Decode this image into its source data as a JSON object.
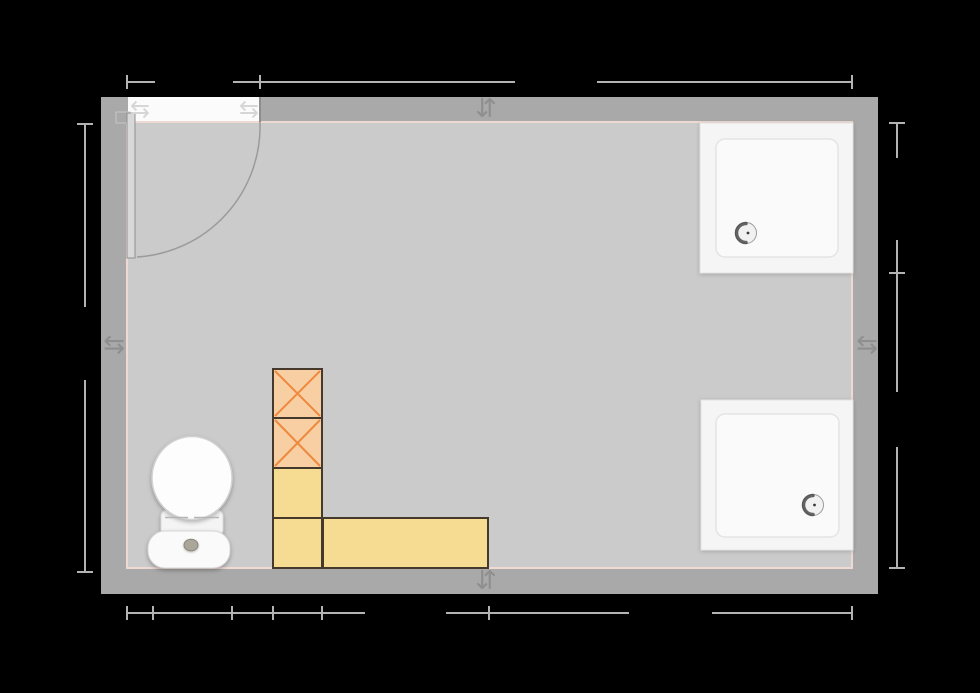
{
  "canvas": {
    "width": 980,
    "height": 693,
    "viewBox": "0 0 980 693",
    "background": "#000000"
  },
  "palette": {
    "wall": "#a9a9a9",
    "floor": "#cbcbcb",
    "inner_wall_trim": "#eed9d3",
    "dimension_line": "#b3b3b3",
    "door_opening": "#fbfbfb",
    "indicator_arrow": "#8f8f8f",
    "box_orange_fill": "#f8cfa3",
    "box_orange_cross": "#ee8a3f",
    "box_yellow_fill": "#f5dc92",
    "box_border": "#45392c",
    "fixture_white": "#f5f5f5"
  },
  "icons": [
    "door-swap-arrows-left-icon",
    "door-swap-arrows-right-icon",
    "wall-direction-indicator-top-icon",
    "wall-direction-indicator-bottom-icon",
    "wall-direction-indicator-left-icon",
    "wall-direction-indicator-right-icon"
  ],
  "scene": [
    {
      "t": "rect",
      "name": "wall-outer",
      "i": true,
      "x": 101,
      "y": 97,
      "w": 777,
      "h": 497,
      "f": "#a9a9a9"
    },
    {
      "t": "rect",
      "name": "room-floor",
      "i": true,
      "x": 127,
      "y": 122,
      "w": 725,
      "h": 446,
      "f": "#cbcbcb",
      "s": "#eed9d3",
      "sw": 2
    },
    {
      "t": "rect",
      "name": "door-opening",
      "i": true,
      "x": 128,
      "y": 97,
      "w": 132,
      "h": 24,
      "f": "#fbfbfb"
    },
    {
      "t": "line",
      "name": "door-jamb-line",
      "i": false,
      "x1": 260,
      "y1": 97,
      "x2": 260,
      "y2": 122,
      "s": "#8d8d8d",
      "sw": 2
    },
    {
      "t": "rect",
      "name": "door-hinge-block",
      "i": false,
      "x": 116,
      "y": 112,
      "w": 14,
      "h": 11,
      "f": "#a9a9a9",
      "s": "#c8c8c8",
      "sw": 1
    },
    {
      "t": "path",
      "name": "door-swing-arc",
      "i": false,
      "d": "M 260 122 A 131 131 0 0 1 137 257",
      "s": "#9b9b9b",
      "sw": 1.5
    },
    {
      "t": "rect",
      "name": "door-panel",
      "i": true,
      "x": 127,
      "y": 113,
      "w": 8,
      "h": 145,
      "f": "#d8d8d8",
      "s": "#8f8f8f",
      "sw": 1
    },
    {
      "t": "text",
      "name": "door-swap-arrows-left-icon",
      "i": false,
      "x": 140,
      "y": 109,
      "str": "⇆",
      "fs": 24,
      "f": "#d6d6d6"
    },
    {
      "t": "text",
      "name": "door-swap-arrows-right-icon",
      "i": false,
      "x": 249,
      "y": 109,
      "str": "⇆",
      "fs": 24,
      "f": "#d6d6d6"
    },
    {
      "t": "text",
      "name": "wall-direction-indicator-top-icon",
      "i": false,
      "x": 486,
      "y": 109,
      "str": "⇵",
      "fs": 26,
      "f": "#8f8f8f"
    },
    {
      "t": "text",
      "name": "wall-direction-indicator-bottom-icon",
      "i": false,
      "x": 486,
      "y": 581,
      "str": "⇵",
      "fs": 26,
      "f": "#8f8f8f"
    },
    {
      "t": "text",
      "name": "wall-direction-indicator-left-icon",
      "i": false,
      "x": 114,
      "y": 345,
      "str": "⇆",
      "fs": 26,
      "f": "#8f8f8f"
    },
    {
      "t": "text",
      "name": "wall-direction-indicator-right-icon",
      "i": false,
      "x": 867,
      "y": 345,
      "str": "⇆",
      "fs": 26,
      "f": "#8f8f8f"
    },
    {
      "t": "rect",
      "name": "shower-tray-outer",
      "i": true,
      "x": 700,
      "y": 123,
      "w": 153,
      "h": 150,
      "f": "#f5f5f5",
      "s": "#e2e2e2",
      "sw": 1
    },
    {
      "t": "rect",
      "name": "shower-tray-basin",
      "i": false,
      "x": 716,
      "y": 139,
      "w": 122,
      "h": 118,
      "rx": 9,
      "f": "#fafafa",
      "s": "#e4e4e4",
      "sw": 1.5
    },
    {
      "t": "circle",
      "name": "shower-drain",
      "i": false,
      "cx": 746,
      "cy": 233,
      "r": 10.5,
      "f": "#f1f1f1",
      "s": "#9c9c9c",
      "sw": 1
    },
    {
      "t": "path",
      "name": "shower-drain-shadow",
      "i": false,
      "d": "M 746 223.5 A 9.5 9.5 0 0 0 746 242.5",
      "s": "#4a4a4a",
      "sw": 3.5,
      "lc": "round",
      "o": 0.85
    },
    {
      "t": "circle",
      "name": "shower-drain-dot",
      "i": false,
      "cx": 748,
      "cy": 233,
      "r": 1.4,
      "f": "#3a3a3a"
    },
    {
      "t": "rect",
      "name": "shower-tray-outer",
      "i": true,
      "x": 701,
      "y": 400,
      "w": 152,
      "h": 150,
      "f": "#f5f5f5",
      "s": "#e2e2e2",
      "sw": 1
    },
    {
      "t": "rect",
      "name": "shower-tray-basin",
      "i": false,
      "x": 716,
      "y": 414,
      "w": 123,
      "h": 123,
      "rx": 9,
      "f": "#fafafa",
      "s": "#e4e4e4",
      "sw": 1.5
    },
    {
      "t": "circle",
      "name": "shower-drain",
      "i": false,
      "cx": 813,
      "cy": 505,
      "r": 10.5,
      "f": "#f1f1f1",
      "s": "#9c9c9c",
      "sw": 1
    },
    {
      "t": "path",
      "name": "shower-drain-shadow",
      "i": false,
      "d": "M 813 495.5 A 9.5 9.5 0 0 0 813 514.5",
      "s": "#4a4a4a",
      "sw": 3.5,
      "lc": "round",
      "o": 0.85
    },
    {
      "t": "circle",
      "name": "shower-drain-dot",
      "i": false,
      "cx": 814.5,
      "cy": 505,
      "r": 1.4,
      "f": "#3a3a3a"
    },
    {
      "t": "rect",
      "name": "storage-box-crossed-1",
      "i": true,
      "x": 273,
      "y": 369,
      "w": 49,
      "h": 49,
      "f": "#f8cfa3",
      "s": "#45392c",
      "sw": 2
    },
    {
      "t": "line",
      "name": "box-cross-line",
      "i": false,
      "x1": 275,
      "y1": 371,
      "x2": 320,
      "y2": 416,
      "s": "#ee8a3f",
      "sw": 2
    },
    {
      "t": "line",
      "name": "box-cross-line",
      "i": false,
      "x1": 320,
      "y1": 371,
      "x2": 275,
      "y2": 416,
      "s": "#ee8a3f",
      "sw": 2
    },
    {
      "t": "rect",
      "name": "storage-box-crossed-2",
      "i": true,
      "x": 273,
      "y": 418,
      "w": 49,
      "h": 50,
      "f": "#f8cfa3",
      "s": "#45392c",
      "sw": 2
    },
    {
      "t": "line",
      "name": "box-cross-line",
      "i": false,
      "x1": 275,
      "y1": 420,
      "x2": 320,
      "y2": 466,
      "s": "#ee8a3f",
      "sw": 2
    },
    {
      "t": "line",
      "name": "box-cross-line",
      "i": false,
      "x1": 320,
      "y1": 420,
      "x2": 275,
      "y2": 466,
      "s": "#ee8a3f",
      "sw": 2
    },
    {
      "t": "rect",
      "name": "storage-box-yellow-1",
      "i": true,
      "x": 273,
      "y": 468,
      "w": 49,
      "h": 50,
      "f": "#f5dc92",
      "s": "#45392c",
      "sw": 2
    },
    {
      "t": "rect",
      "name": "storage-box-yellow-2",
      "i": true,
      "x": 273,
      "y": 518,
      "w": 49,
      "h": 50,
      "f": "#f5dc92",
      "s": "#45392c",
      "sw": 2
    },
    {
      "t": "rect",
      "name": "storage-box-yellow-long",
      "i": true,
      "x": 323,
      "y": 518,
      "w": 165,
      "h": 50,
      "f": "#f5dc92",
      "s": "#45392c",
      "sw": 2
    },
    {
      "t": "rect",
      "name": "toilet-seat",
      "i": true,
      "x": 161,
      "y": 510,
      "w": 62,
      "h": 26,
      "rx": 6,
      "f": "#f4f4f4",
      "s": "#dadada",
      "sw": 1
    },
    {
      "t": "rect",
      "name": "toilet-tank",
      "i": true,
      "x": 148,
      "y": 531,
      "w": 82,
      "h": 37,
      "rx": 17,
      "f": "#fafafa",
      "s": "#d6d6d6",
      "sw": 1
    },
    {
      "t": "ellipse",
      "name": "toilet-lid",
      "i": true,
      "cx": 192,
      "cy": 478,
      "rx": 40,
      "ry": 41.5,
      "f": "#fdfdfd",
      "s": "#d2d2d2",
      "sw": 1.5
    },
    {
      "t": "line",
      "name": "toilet-lid-seam",
      "i": false,
      "x1": 165,
      "y1": 517.5,
      "x2": 188,
      "y2": 517.5,
      "s": "#b5b5b5",
      "sw": 1.5
    },
    {
      "t": "line",
      "name": "toilet-lid-seam",
      "i": false,
      "x1": 194,
      "y1": 517.5,
      "x2": 219,
      "y2": 517.5,
      "s": "#b5b5b5",
      "sw": 1.5
    },
    {
      "t": "ellipse",
      "name": "flush-button",
      "i": false,
      "cx": 191,
      "cy": 545,
      "rx": 7,
      "ry": 5.8,
      "f": "#aaa699",
      "s": "#8a867a",
      "sw": 1
    },
    {
      "t": "line",
      "name": "dimension-top-segment",
      "i": true,
      "x1": 127,
      "y1": 82,
      "x2": 155,
      "y2": 82,
      "s": "#b3b3b3",
      "sw": 2
    },
    {
      "t": "line",
      "name": "dimension-top-segment",
      "i": true,
      "x1": 233,
      "y1": 82,
      "x2": 515,
      "y2": 82,
      "s": "#b3b3b3",
      "sw": 2
    },
    {
      "t": "line",
      "name": "dimension-top-segment",
      "i": true,
      "x1": 597,
      "y1": 82,
      "x2": 852,
      "y2": 82,
      "s": "#b3b3b3",
      "sw": 2
    },
    {
      "t": "line",
      "name": "dimension-top-tick",
      "i": false,
      "x1": 127,
      "y1": 75,
      "x2": 127,
      "y2": 89,
      "s": "#b3b3b3",
      "sw": 2
    },
    {
      "t": "line",
      "name": "dimension-top-tick",
      "i": false,
      "x1": 260,
      "y1": 75,
      "x2": 260,
      "y2": 89,
      "s": "#b3b3b3",
      "sw": 2
    },
    {
      "t": "line",
      "name": "dimension-top-tick",
      "i": false,
      "x1": 852,
      "y1": 75,
      "x2": 852,
      "y2": 89,
      "s": "#b3b3b3",
      "sw": 2
    },
    {
      "t": "line",
      "name": "dimension-bottom-segment",
      "i": true,
      "x1": 127,
      "y1": 613,
      "x2": 365,
      "y2": 613,
      "s": "#b3b3b3",
      "sw": 2
    },
    {
      "t": "line",
      "name": "dimension-bottom-segment",
      "i": true,
      "x1": 446,
      "y1": 613,
      "x2": 629,
      "y2": 613,
      "s": "#b3b3b3",
      "sw": 2
    },
    {
      "t": "line",
      "name": "dimension-bottom-segment",
      "i": true,
      "x1": 712,
      "y1": 613,
      "x2": 852,
      "y2": 613,
      "s": "#b3b3b3",
      "sw": 2
    },
    {
      "t": "line",
      "name": "dimension-bottom-tick",
      "i": false,
      "x1": 127,
      "y1": 606,
      "x2": 127,
      "y2": 620,
      "s": "#b3b3b3",
      "sw": 2
    },
    {
      "t": "line",
      "name": "dimension-bottom-tick",
      "i": false,
      "x1": 153,
      "y1": 606,
      "x2": 153,
      "y2": 620,
      "s": "#b3b3b3",
      "sw": 2
    },
    {
      "t": "line",
      "name": "dimension-bottom-tick",
      "i": false,
      "x1": 232,
      "y1": 606,
      "x2": 232,
      "y2": 620,
      "s": "#b3b3b3",
      "sw": 2
    },
    {
      "t": "line",
      "name": "dimension-bottom-tick",
      "i": false,
      "x1": 273,
      "y1": 606,
      "x2": 273,
      "y2": 620,
      "s": "#b3b3b3",
      "sw": 2
    },
    {
      "t": "line",
      "name": "dimension-bottom-tick",
      "i": false,
      "x1": 322,
      "y1": 606,
      "x2": 322,
      "y2": 620,
      "s": "#b3b3b3",
      "sw": 2
    },
    {
      "t": "line",
      "name": "dimension-bottom-tick",
      "i": false,
      "x1": 489,
      "y1": 606,
      "x2": 489,
      "y2": 620,
      "s": "#b3b3b3",
      "sw": 2
    },
    {
      "t": "line",
      "name": "dimension-bottom-tick",
      "i": false,
      "x1": 852,
      "y1": 606,
      "x2": 852,
      "y2": 620,
      "s": "#b3b3b3",
      "sw": 2
    },
    {
      "t": "line",
      "name": "dimension-left-segment",
      "i": true,
      "x1": 85,
      "y1": 124,
      "x2": 85,
      "y2": 307,
      "s": "#b3b3b3",
      "sw": 2
    },
    {
      "t": "line",
      "name": "dimension-left-segment",
      "i": true,
      "x1": 85,
      "y1": 380,
      "x2": 85,
      "y2": 572,
      "s": "#b3b3b3",
      "sw": 2
    },
    {
      "t": "line",
      "name": "dimension-left-tick",
      "i": false,
      "x1": 77,
      "y1": 124,
      "x2": 93,
      "y2": 124,
      "s": "#b3b3b3",
      "sw": 2
    },
    {
      "t": "line",
      "name": "dimension-left-tick",
      "i": false,
      "x1": 77,
      "y1": 572,
      "x2": 93,
      "y2": 572,
      "s": "#b3b3b3",
      "sw": 2
    },
    {
      "t": "line",
      "name": "dimension-right-segment",
      "i": true,
      "x1": 897,
      "y1": 123,
      "x2": 897,
      "y2": 158,
      "s": "#b3b3b3",
      "sw": 2
    },
    {
      "t": "line",
      "name": "dimension-right-segment",
      "i": true,
      "x1": 897,
      "y1": 240,
      "x2": 897,
      "y2": 392,
      "s": "#b3b3b3",
      "sw": 2
    },
    {
      "t": "line",
      "name": "dimension-right-segment",
      "i": true,
      "x1": 897,
      "y1": 447,
      "x2": 897,
      "y2": 568,
      "s": "#b3b3b3",
      "sw": 2
    },
    {
      "t": "line",
      "name": "dimension-right-tick",
      "i": false,
      "x1": 889,
      "y1": 123,
      "x2": 905,
      "y2": 123,
      "s": "#b3b3b3",
      "sw": 2
    },
    {
      "t": "line",
      "name": "dimension-right-tick",
      "i": false,
      "x1": 889,
      "y1": 273,
      "x2": 905,
      "y2": 273,
      "s": "#b3b3b3",
      "sw": 2
    },
    {
      "t": "line",
      "name": "dimension-right-tick",
      "i": false,
      "x1": 889,
      "y1": 568,
      "x2": 905,
      "y2": 568,
      "s": "#b3b3b3",
      "sw": 2
    }
  ]
}
